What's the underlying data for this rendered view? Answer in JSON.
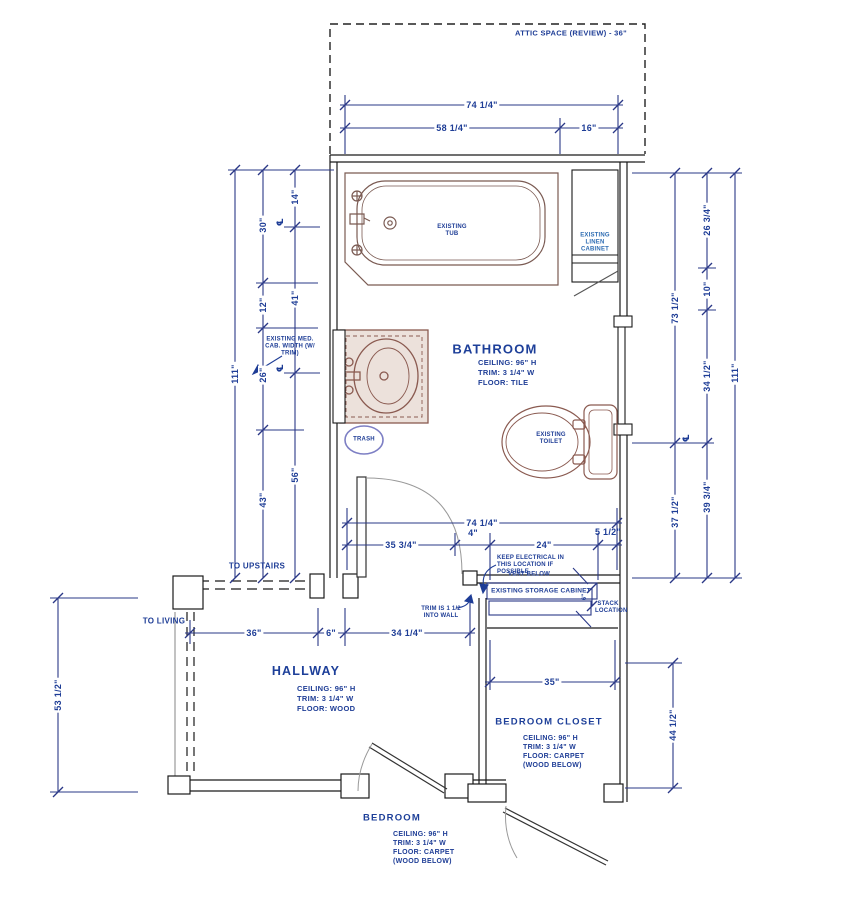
{
  "drawing": {
    "attic_label": "ATTIC SPACE (REVIEW) - 36\"",
    "rooms": {
      "bathroom": {
        "name": "BATHROOM",
        "ceiling": "CEILING: 96\" H",
        "trim": "TRIM: 3 1/4\" W",
        "floor": "FLOOR: TILE"
      },
      "hallway": {
        "name": "HALLWAY",
        "ceiling": "CEILING: 96\" H",
        "trim": "TRIM: 3 1/4\" W",
        "floor": "FLOOR: WOOD"
      },
      "bedroom_closet": {
        "name": "BEDROOM CLOSET",
        "ceiling": "CEILING: 96\" H",
        "trim": "TRIM: 3 1/4\" W",
        "floor": "FLOOR: CARPET",
        "floor_note": "(WOOD BELOW)"
      },
      "bedroom": {
        "name": "BEDROOM",
        "ceiling": "CEILING: 96\" H",
        "trim": "TRIM: 3 1/4\" W",
        "floor": "FLOOR: CARPET",
        "floor_note": "(WOOD BELOW)"
      }
    },
    "fixtures": {
      "tub": "EXISTING TUB",
      "linen": "EXISTING LINEN CABINET",
      "toilet": "EXISTING TOILET",
      "trash": "TRASH",
      "storage": "EXISTING STORAGE CABINET",
      "stack": "STACK LOCATION"
    },
    "notes": {
      "med_cab": "EXISTING MED. CAB. WIDTH (W/ TRIM)",
      "electrical": "KEEP ELECTRICAL IN THIS LOCATION IF POSSIBLE",
      "vent": "VENT BELOW",
      "trim_wall": "TRIM IS 1 1/2 INTO WALL",
      "to_upstairs": "TO UPSTAIRS",
      "to_living": "TO LIVING"
    },
    "dims": {
      "top_total": "74 1/4\"",
      "top_a": "58 1/4\"",
      "top_b": "16\"",
      "left_total": "111\"",
      "left_b0": "30\"",
      "left_b1": "12\"",
      "left_b2": "26\"",
      "left_b3": "43\"",
      "left_c0": "14\"",
      "left_c1": "41\"",
      "left_c2": "56\"",
      "right_total": "111\"",
      "right_a0": "73 1/2\"",
      "right_a1": "37 1/2\"",
      "right_b0": "26 3/4\"",
      "right_b1": "10\"",
      "right_b2": "34 1/2\"",
      "right_b3": "39 3/4\"",
      "bath_total": "74 1/4\"",
      "bath_s0": "35 3/4\"",
      "bath_s1": "4\"",
      "bath_s2": "24\"",
      "bath_s3": "5 1/2\"",
      "hall_0": "36\"",
      "hall_1": "6\"",
      "hall_2": "34 1/4\"",
      "hall_left": "53 1/2\"",
      "closet_w": "35\"",
      "closet_d": "44 1/2\"",
      "cabinet": "6\"",
      "cl": "℄"
    }
  }
}
